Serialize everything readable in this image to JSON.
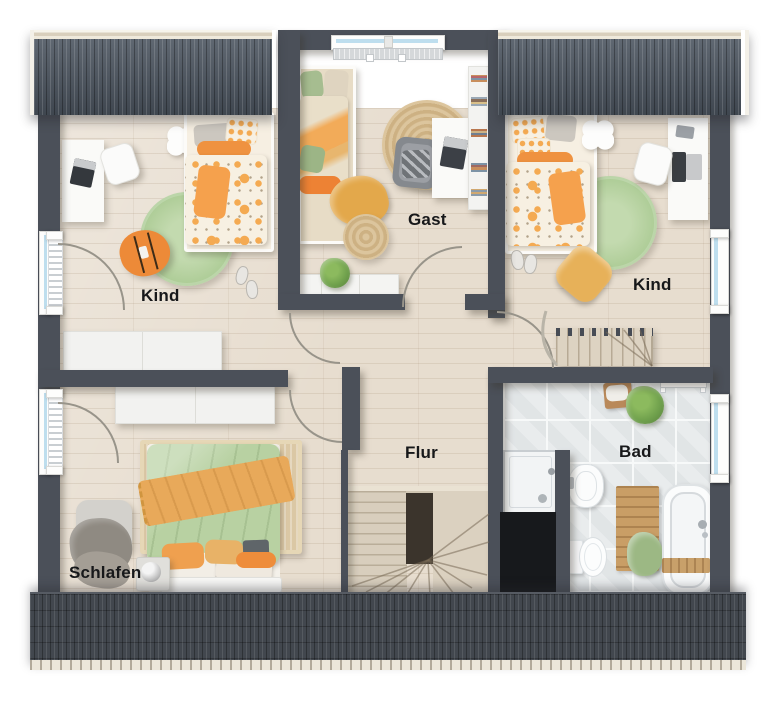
{
  "meta": {
    "type": "floor-plan",
    "view": "top-down upper floor"
  },
  "rooms": [
    {
      "id": "kind-left",
      "label": "Kind"
    },
    {
      "id": "gast",
      "label": "Gast"
    },
    {
      "id": "kind-right",
      "label": "Kind"
    },
    {
      "id": "flur",
      "label": "Flur"
    },
    {
      "id": "bad",
      "label": "Bad"
    },
    {
      "id": "schlafen",
      "label": "Schlafen"
    }
  ],
  "palette": {
    "wall": "#4b5059",
    "roof_top": "#4d5661",
    "roof_bottom": "#42474e",
    "gutter": "#f1ede2",
    "floor_wood": "#e7ddcf",
    "floor_tile": "#e9eced",
    "rug_green": "#b5d19f",
    "rug_jute": "#d9c29a",
    "accent_orange": "#ee8d3c",
    "accent_mustard": "#e8ad5b",
    "bedding_green": "#b8d1a2",
    "shaft_black": "#17191c",
    "window_glass": "#bedeee"
  }
}
